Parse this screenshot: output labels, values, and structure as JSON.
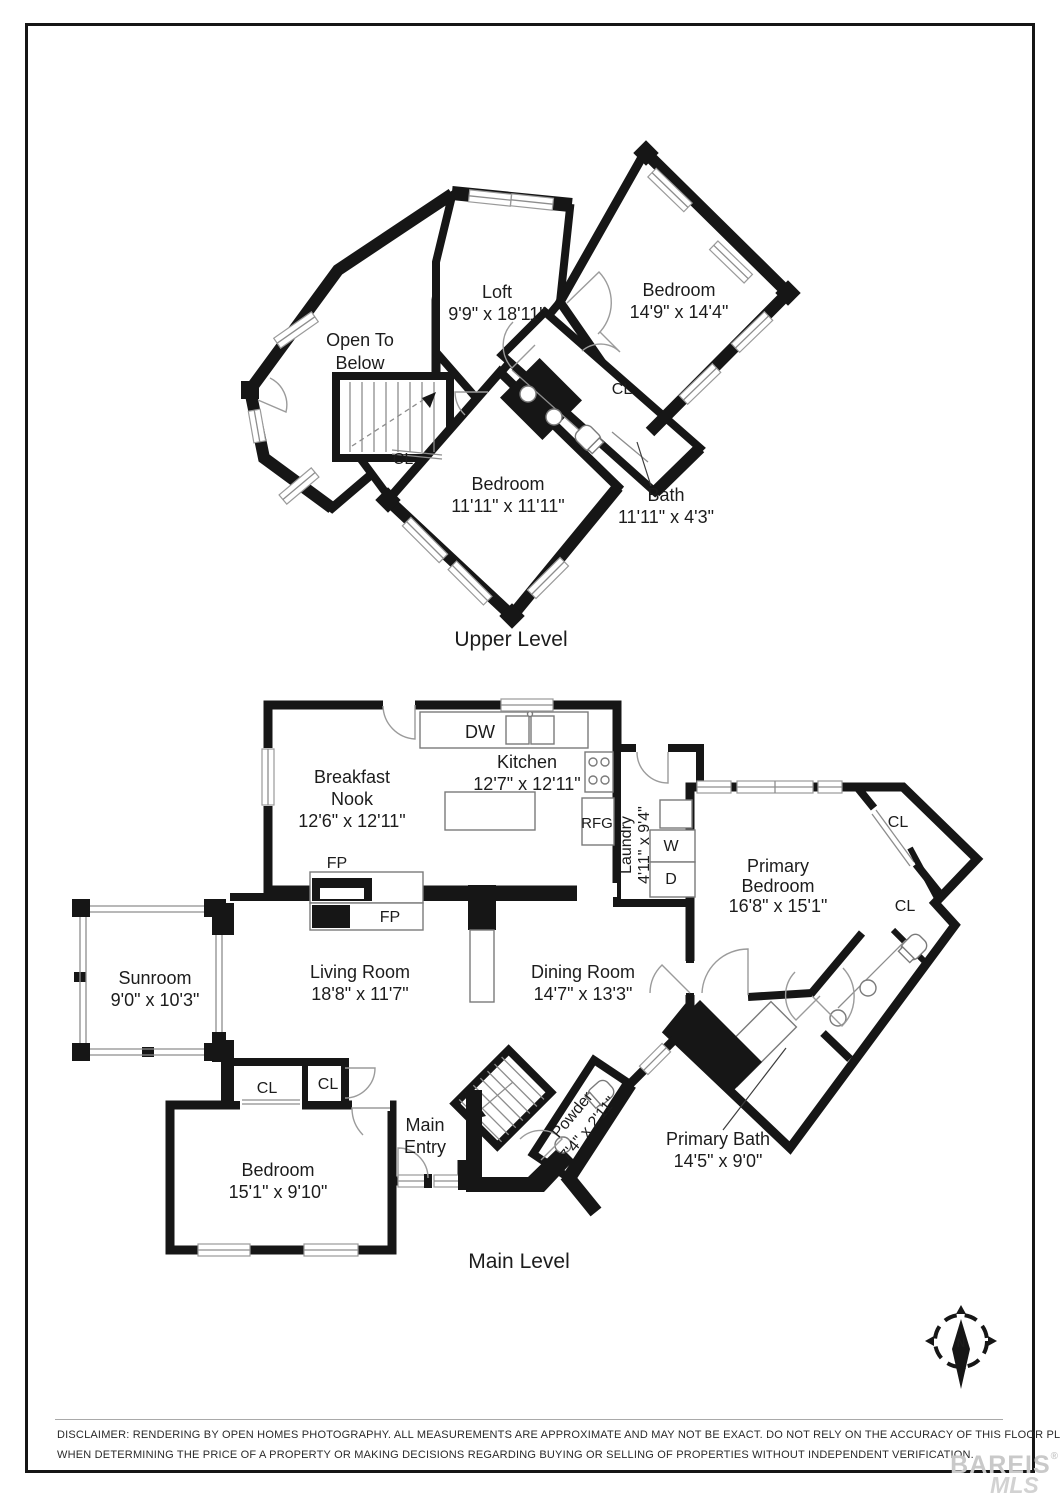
{
  "upper": {
    "title": "Upper Level",
    "loft": {
      "name": "Loft",
      "dims": "9'9\" x 18'11\""
    },
    "bedroom1": {
      "name": "Bedroom",
      "dims": "14'9\" x 14'4\""
    },
    "open_to_below": {
      "line1": "Open To",
      "line2": "Below"
    },
    "bedroom2": {
      "name": "Bedroom",
      "dims": "11'11\" x 11'11\""
    },
    "bath": {
      "name": "Bath",
      "dims": "11'11\" x 4'3\""
    },
    "closet": "CL"
  },
  "main": {
    "title": "Main Level",
    "breakfast_nook": {
      "line1": "Breakfast",
      "line2": "Nook",
      "dims": "12'6\" x 12'11\""
    },
    "kitchen": {
      "name": "Kitchen",
      "dims": "12'7\" x 12'11\""
    },
    "laundry": {
      "name": "Laundry",
      "dims": "4'11\" x 9'4\""
    },
    "primary_bedroom": {
      "line1": "Primary",
      "line2": "Bedroom",
      "dims": "16'8\" x 15'1\""
    },
    "sunroom": {
      "name": "Sunroom",
      "dims": "9'0\" x 10'3\""
    },
    "living_room": {
      "name": "Living Room",
      "dims": "18'8\" x 11'7\""
    },
    "dining_room": {
      "name": "Dining Room",
      "dims": "14'7\" x 13'3\""
    },
    "bedroom": {
      "name": "Bedroom",
      "dims": "15'1\" x 9'10\""
    },
    "main_entry": {
      "line1": "Main",
      "line2": "Entry"
    },
    "powder": {
      "name": "Powder",
      "dims": "7'4\" x 2'11\""
    },
    "primary_bath": {
      "name": "Primary Bath",
      "dims": "14'5\" x 9'0\""
    },
    "closet": "CL",
    "fireplace": "FP",
    "dishwasher": "DW",
    "refrigerator": "RFG",
    "washer": "W",
    "dryer": "D"
  },
  "compass": {
    "north": "N"
  },
  "disclaimer": {
    "line1": "DISCLAIMER: RENDERING BY OPEN HOMES PHOTOGRAPHY. ALL MEASUREMENTS ARE APPROXIMATE AND MAY NOT BE EXACT. DO NOT RELY ON THE ACCURACY OF THIS FLOOR PLAN",
    "line2": "WHEN DETERMINING THE PRICE OF A PROPERTY OR MAKING DECISIONS REGARDING BUYING OR SELLING OF PROPERTIES WITHOUT INDEPENDENT VERIFICATION."
  },
  "watermark": {
    "brand": "BAREIS",
    "reg": "®",
    "mls": "MLS"
  }
}
